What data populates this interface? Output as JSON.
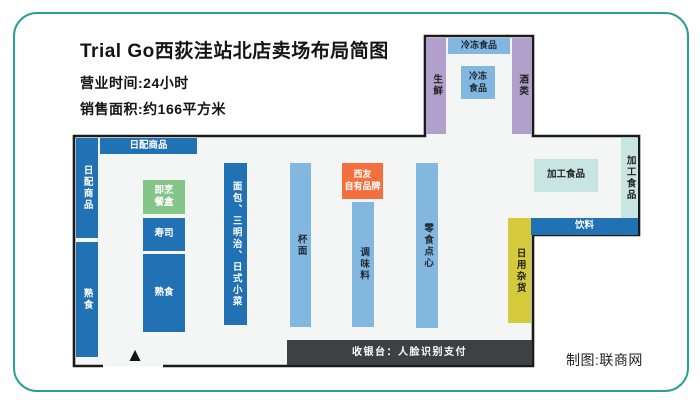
{
  "header": {
    "title": "Trial Go西荻洼站北店卖场布局简图",
    "business_hours": "营业时间:24小时",
    "sales_area": "销售面积:约166平方米"
  },
  "floorplan": {
    "top_wing": {
      "fresh": "生鲜",
      "frozen_bar": "冷冻食品",
      "frozen_island": "冷冻\n食品",
      "alcohol": "酒类"
    },
    "left": {
      "dairy_bar": "日配商品",
      "dairy_wall": "日配商品",
      "deli_wall": "熟食"
    },
    "center": {
      "ready_meal": "即烹\n餐盒",
      "sushi": "寿司",
      "deli": "熟食",
      "bread": "面包、三明治、日式小菜",
      "cup_noodles": "杯面",
      "seiyu_brand": "西友\n自有品牌",
      "seasoning": "调味料",
      "snacks": "零食点心"
    },
    "right_wing": {
      "processed_island": "加工食品",
      "processed_wall": "加工食品",
      "drinks": "饮料",
      "daily_goods": "日用杂货"
    },
    "checkout": "收银台：人脸识别支付"
  },
  "icons": {
    "entrance_triangle": "▲"
  },
  "credit": "制图:联商网",
  "colors": {
    "card_border": "#2b9e98",
    "wall_outline": "#1b1b1b",
    "floor": "#f4f5f5",
    "dark_blue": "#2171b5",
    "light_blue": "#82b7e0",
    "purple": "#b0a0cb",
    "green": "#85c58a",
    "orange": "#f3703e",
    "light_teal": "#c9e5e2",
    "yellow": "#d5c93c",
    "checkout_gray": "#3e4042",
    "text_dark": "#1a1a1a",
    "text_light": "#ffffff"
  }
}
